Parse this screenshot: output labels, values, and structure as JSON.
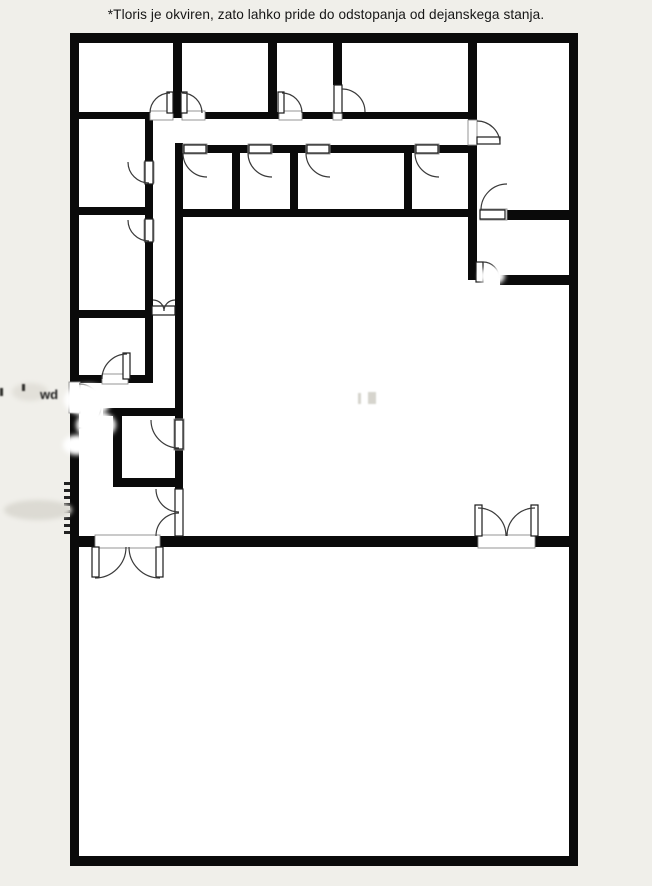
{
  "page": {
    "bg": "#f0efea",
    "plan_fill": "#ffffff",
    "wall_color": "#0a0a0a",
    "arc_color": "#3a3a3a",
    "leaf_stroke": "#1a1a1a",
    "jamb_color": "#8a8a8a",
    "text_color": "#161616"
  },
  "disclaimer": "*Tloris je okviren, zato lahko pride do odstopanja od dejanskega stanja.",
  "floorplan": {
    "canvas": {
      "w": 652,
      "h": 886
    },
    "interior": {
      "x": 79,
      "y": 43,
      "w": 490,
      "h": 813
    },
    "walls": [
      [
        70,
        33,
        508,
        10
      ],
      [
        70,
        33,
        9,
        349
      ],
      [
        70,
        413,
        9,
        453
      ],
      [
        569,
        33,
        9,
        833
      ],
      [
        70,
        856,
        508,
        10
      ],
      [
        173,
        43,
        9,
        75
      ],
      [
        268,
        43,
        9,
        75
      ],
      [
        333,
        43,
        9,
        42
      ],
      [
        468,
        43,
        9,
        77
      ],
      [
        468,
        145,
        9,
        135
      ],
      [
        79,
        112,
        71,
        7
      ],
      [
        205,
        112,
        74,
        7
      ],
      [
        302,
        112,
        166,
        7
      ],
      [
        207,
        145,
        41,
        8
      ],
      [
        272,
        145,
        34,
        8
      ],
      [
        330,
        145,
        85,
        8
      ],
      [
        439,
        145,
        29,
        8
      ],
      [
        232,
        153,
        8,
        58
      ],
      [
        290,
        153,
        8,
        58
      ],
      [
        404,
        153,
        8,
        58
      ],
      [
        175,
        209,
        293,
        8
      ],
      [
        145,
        118,
        8,
        44
      ],
      [
        145,
        183,
        8,
        37
      ],
      [
        145,
        241,
        8,
        141
      ],
      [
        175,
        143,
        8,
        277
      ],
      [
        175,
        450,
        8,
        39
      ],
      [
        79,
        207,
        74,
        8
      ],
      [
        79,
        310,
        74,
        8
      ],
      [
        79,
        375,
        24,
        8
      ],
      [
        127,
        375,
        26,
        8
      ],
      [
        103,
        408,
        80,
        8
      ],
      [
        113,
        416,
        9,
        62
      ],
      [
        113,
        478,
        70,
        9
      ],
      [
        79,
        536,
        16,
        11
      ],
      [
        160,
        536,
        318,
        11
      ],
      [
        535,
        536,
        34,
        11
      ],
      [
        507,
        210,
        62,
        10
      ],
      [
        500,
        275,
        69,
        10
      ]
    ],
    "openings": [
      [
        150,
        111,
        23,
        9
      ],
      [
        182,
        111,
        23,
        9
      ],
      [
        279,
        111,
        23,
        9
      ],
      [
        333,
        111,
        9,
        9
      ],
      [
        468,
        120,
        9,
        25
      ],
      [
        183,
        144,
        24,
        10
      ],
      [
        248,
        144,
        24,
        10
      ],
      [
        306,
        144,
        24,
        10
      ],
      [
        415,
        144,
        24,
        10
      ],
      [
        144,
        162,
        10,
        21
      ],
      [
        144,
        220,
        10,
        21
      ],
      [
        102,
        374,
        26,
        10
      ],
      [
        174,
        419,
        10,
        31
      ],
      [
        69,
        382,
        11,
        31
      ],
      [
        480,
        209,
        27,
        11
      ],
      [
        95,
        535,
        65,
        13
      ],
      [
        478,
        535,
        57,
        13
      ]
    ],
    "leaves": [
      [
        167,
        92,
        6,
        21
      ],
      [
        181,
        92,
        6,
        21
      ],
      [
        278,
        92,
        6,
        21
      ],
      [
        334,
        85,
        8,
        28
      ],
      [
        477,
        137,
        23,
        7
      ],
      [
        184,
        145,
        22,
        8
      ],
      [
        249,
        145,
        22,
        8
      ],
      [
        307,
        145,
        22,
        8
      ],
      [
        416,
        145,
        22,
        8
      ],
      [
        145,
        161,
        8,
        23
      ],
      [
        145,
        219,
        8,
        23
      ],
      [
        123,
        353,
        7,
        26
      ],
      [
        152,
        306,
        23,
        9
      ],
      [
        175,
        420,
        8,
        29
      ],
      [
        175,
        489,
        8,
        47
      ],
      [
        480,
        210,
        25,
        9
      ],
      [
        476,
        262,
        7,
        20
      ],
      [
        92,
        547,
        7,
        30
      ],
      [
        156,
        547,
        7,
        30
      ],
      [
        475,
        505,
        7,
        31
      ],
      [
        531,
        505,
        7,
        31
      ]
    ],
    "arcs": [
      "M150 113 A20 20 0 0 1 170 93",
      "M202 113 A20 20 0 0 0 182 93",
      "M302 113 A20 20 0 0 0 282 93",
      "M342 89 A23 23 0 0 1 365 112",
      "M500 144 A23 23 0 0 0 477 121",
      "M183 153 A24 24 0 0 0 207 177",
      "M248 153 A24 24 0 0 0 272 177",
      "M306 153 A24 24 0 0 0 330 177",
      "M415 153 A24 24 0 0 0 439 177",
      "M128 162 A21 21 0 0 0 149 183",
      "M128 220 A21 21 0 0 0 149 241",
      "M102 379 A25 25 0 0 1 127 354",
      "M153 300 A11 11 0 0 1 164 311",
      "M175 300 A11 11 0 0 0 164 311",
      "M151 420 A28 28 0 0 0 179 448",
      "M156 489 A23 23 0 0 0 179 512",
      "M156 536 A23 23 0 0 1 179 513",
      "M79 384 A22 22 0 0 1 79 428",
      "M95 578 A31 31 0 0 0 126 547",
      "M160 578 A31 31 0 0 1 129 547",
      "M478 508 A28 28 0 0 1 506 536",
      "M535 508 A28 28 0 0 0 507 536",
      "M507 184 A26 26 0 0 0 481 210",
      "M483 262 A16 16 0 0 1 499 278"
    ],
    "wall_ticks": [
      [
        64,
        482,
        6,
        3
      ],
      [
        64,
        489,
        6,
        3
      ],
      [
        64,
        496,
        6,
        3
      ],
      [
        64,
        503,
        6,
        3
      ],
      [
        64,
        510,
        6,
        3
      ],
      [
        64,
        517,
        6,
        3
      ],
      [
        64,
        524,
        6,
        3
      ],
      [
        64,
        531,
        6,
        3
      ]
    ],
    "smudges": {
      "white_blobs": [
        {
          "cx": 88,
          "cy": 400,
          "rx": 24,
          "ry": 16
        },
        {
          "cx": 96,
          "cy": 425,
          "rx": 20,
          "ry": 14
        },
        {
          "cx": 77,
          "cy": 445,
          "rx": 14,
          "ry": 10
        },
        {
          "cx": 492,
          "cy": 276,
          "rx": 13,
          "ry": 9
        }
      ],
      "gray_blobs": [
        {
          "cx": 38,
          "cy": 510,
          "rx": 34,
          "ry": 10,
          "fill": "#dcdad3"
        },
        {
          "cx": 30,
          "cy": 392,
          "rx": 18,
          "ry": 9,
          "fill": "#e2e0d9"
        }
      ],
      "wd_text": "wd",
      "wd_pos": {
        "x": 40,
        "y": 399
      },
      "dark_marks": [
        [
          22,
          384,
          3,
          7
        ],
        [
          0,
          388,
          3,
          8
        ]
      ],
      "faint_marks": [
        [
          358,
          393,
          3,
          11
        ],
        [
          368,
          392,
          8,
          12
        ]
      ]
    }
  }
}
